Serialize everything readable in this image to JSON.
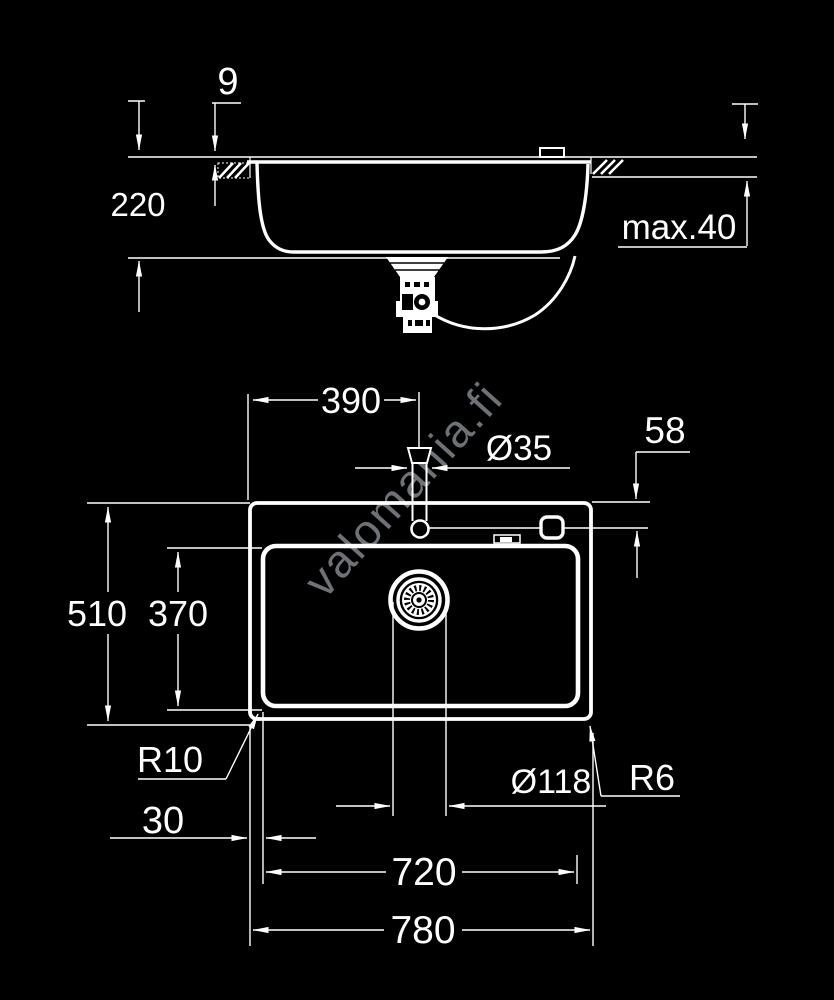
{
  "background": "#000000",
  "line_color": "#ffffff",
  "watermark": {
    "text": "valomania.fi",
    "color": "rgba(200,206,215,0.55)"
  },
  "section_view": {
    "dims": {
      "rim_offset": "9",
      "bowl_depth": "220",
      "counter_thickness": "max.40"
    }
  },
  "top_view": {
    "dims": {
      "tap_from_left": "390",
      "tap_hole_dia": "Ø35",
      "tap_from_back": "58",
      "total_depth": "510",
      "bowl_inner_depth": "370",
      "bowl_corner_radius": "R10",
      "rim_to_bowl": "30",
      "drain_dia": "Ø118",
      "rim_corner_radius": "R6",
      "bowl_inner_width": "720",
      "total_width": "780"
    }
  }
}
